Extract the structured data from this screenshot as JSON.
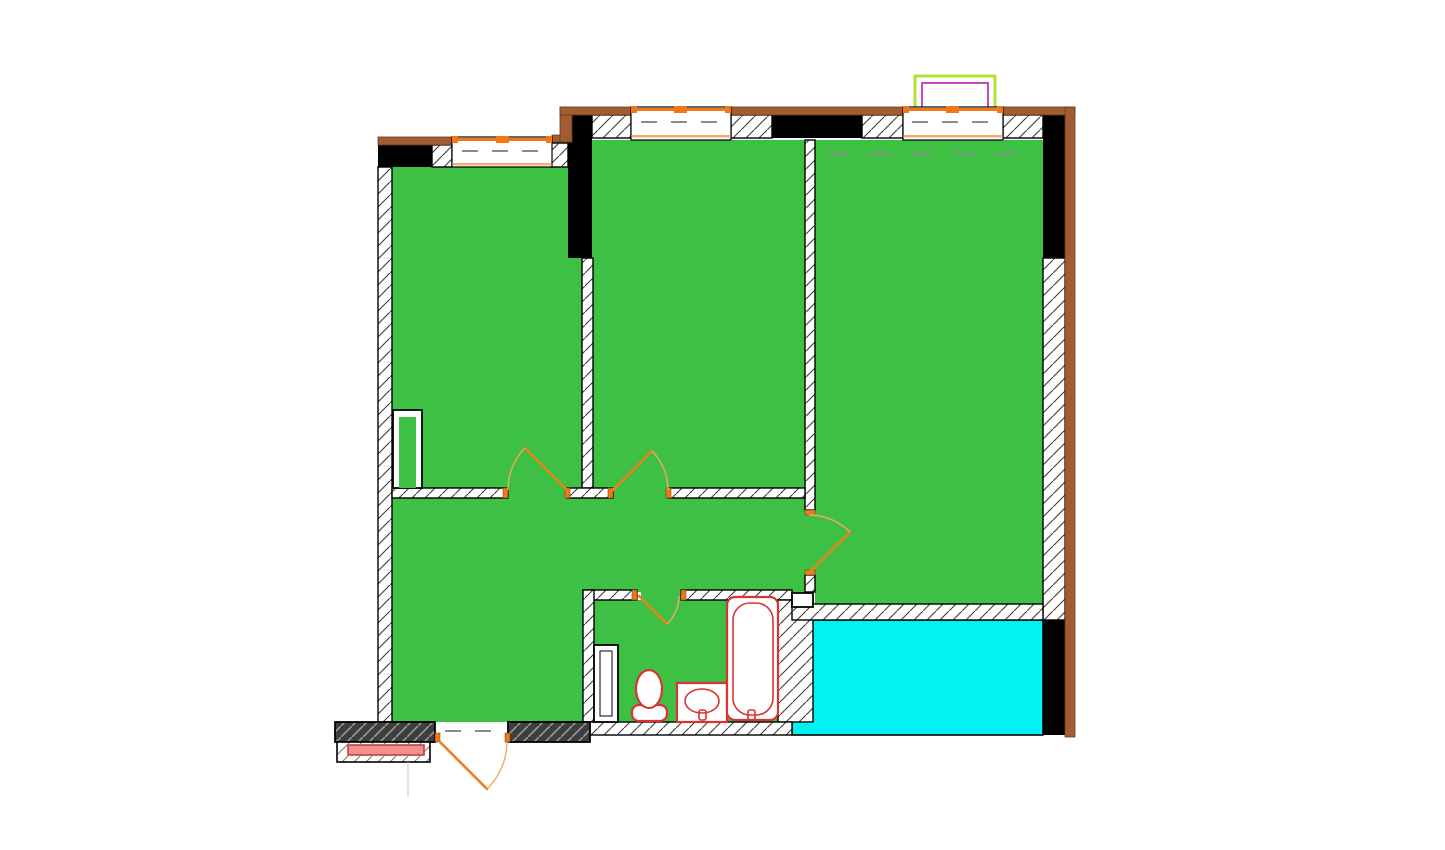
{
  "plan": {
    "kind": "floor-plan",
    "rooms": [
      {
        "name": "room-top-left",
        "fill": "green"
      },
      {
        "name": "room-top-middle",
        "fill": "green"
      },
      {
        "name": "room-top-right",
        "fill": "green"
      },
      {
        "name": "hall",
        "fill": "green"
      },
      {
        "name": "bathroom",
        "fill": "green"
      },
      {
        "name": "balcony",
        "fill": "cyan"
      }
    ],
    "fixtures": [
      "toilet",
      "sink",
      "bathtub"
    ],
    "windows_count": 3,
    "doors_count": 5
  },
  "colors": {
    "page_bg": "#FFFFFF",
    "room_green": "#3DC044",
    "balcony_cyan": "#00F2F2",
    "hatch_line": "#3C3C3C",
    "structural_black": "#000000",
    "line_black": "#000000",
    "exterior_brown": "#A05C32",
    "brown_edge": "#6E3A17",
    "entry_dark": "#3E3E3E",
    "entry_dark_hatch": "#9A9A9A",
    "window_orange": "#F07818",
    "door_orange": "#E8821E",
    "door_arc_orange": "#F2A95F",
    "fixture_red": "#D93434",
    "porch_pink": "#F29090",
    "porch_pink_border": "#C24040",
    "box_green": "#B5E033",
    "box_magenta": "#C648C6",
    "dash_gray": "#8C8C8C",
    "faint_gray": "#C8C8C8"
  }
}
